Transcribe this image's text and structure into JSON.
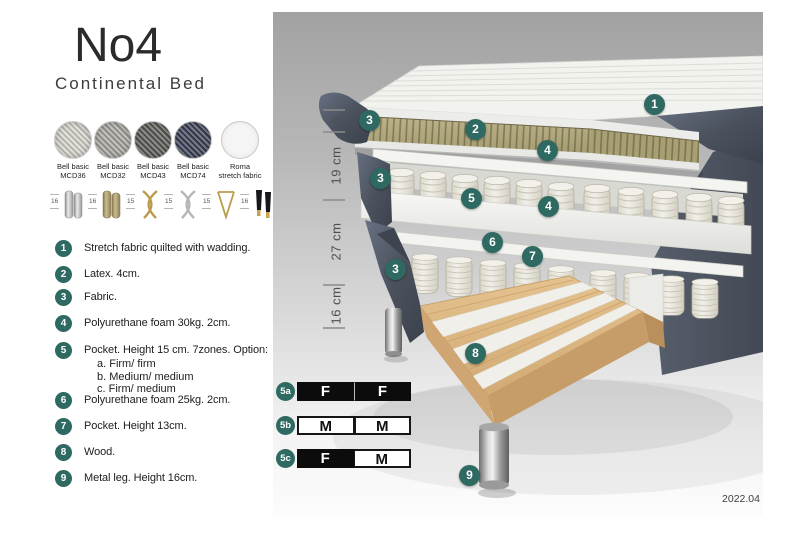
{
  "product": {
    "model": "No4",
    "type": "Continental Bed"
  },
  "fabric_swatches": [
    {
      "line1": "Bell basic",
      "line2": "MCD36",
      "color": "#d8d5cd"
    },
    {
      "line1": "Bell basic",
      "line2": "MCD32",
      "color": "#a9a7a1"
    },
    {
      "line1": "Bell basic",
      "line2": "MCD43",
      "color": "#5c5c58"
    },
    {
      "line1": "Bell basic",
      "line2": "MCD74",
      "color": "#3e4257"
    },
    {
      "line1": "Roma",
      "line2": "stretch fabric",
      "color": "#f5f5f5"
    }
  ],
  "leg_options": [
    {
      "height": "16",
      "style": "cylinder chrome"
    },
    {
      "height": "16",
      "style": "cylinder brass"
    },
    {
      "height": "15",
      "style": "cross gold"
    },
    {
      "height": "15",
      "style": "cross silver"
    },
    {
      "height": "15",
      "style": "hairpin gold"
    },
    {
      "height": "16",
      "style": "tapered black with gold foot"
    }
  ],
  "features": [
    {
      "num": "1",
      "text": "Stretch fabric quilted with wadding."
    },
    {
      "num": "2",
      "text": "Latex. 4cm."
    },
    {
      "num": "3",
      "text": "Fabric."
    },
    {
      "num": "4",
      "text": "Polyurethane foam 30kg. 2cm."
    },
    {
      "num": "5",
      "text": "Pocket. Height 15 cm. 7zones. Option:",
      "options": [
        "a. Firm/ firm",
        "b. Medium/ medium",
        "c. Firm/ medium"
      ]
    },
    {
      "num": "6",
      "text": "Polyurethane foam 25kg. 2cm."
    },
    {
      "num": "7",
      "text": "Pocket. Height 13cm."
    },
    {
      "num": "8",
      "text": "Wood."
    },
    {
      "num": "9",
      "text": "Metal leg. Height 16cm."
    }
  ],
  "illustration": {
    "callouts": [
      "1",
      "3",
      "2",
      "4",
      "3",
      "5",
      "4",
      "6",
      "7",
      "3",
      "8",
      "9"
    ],
    "dimensions": [
      "6",
      "19 cm",
      "27 cm",
      "16 cm"
    ],
    "version": "2022.04"
  },
  "firmness_options": [
    {
      "id": "5a",
      "cells": [
        {
          "label": "F",
          "fill": "black"
        },
        {
          "label": "F",
          "fill": "black"
        }
      ]
    },
    {
      "id": "5b",
      "cells": [
        {
          "label": "M",
          "fill": "white"
        },
        {
          "label": "M",
          "fill": "white"
        }
      ]
    },
    {
      "id": "5c",
      "cells": [
        {
          "label": "F",
          "fill": "black"
        },
        {
          "label": "M",
          "fill": "white"
        }
      ]
    }
  ],
  "colors": {
    "accent_teal": "#2e6a62",
    "fabric_gray": "#4d5461",
    "latex_khaki": "#b3aa80",
    "wood": "#ddb17c"
  }
}
